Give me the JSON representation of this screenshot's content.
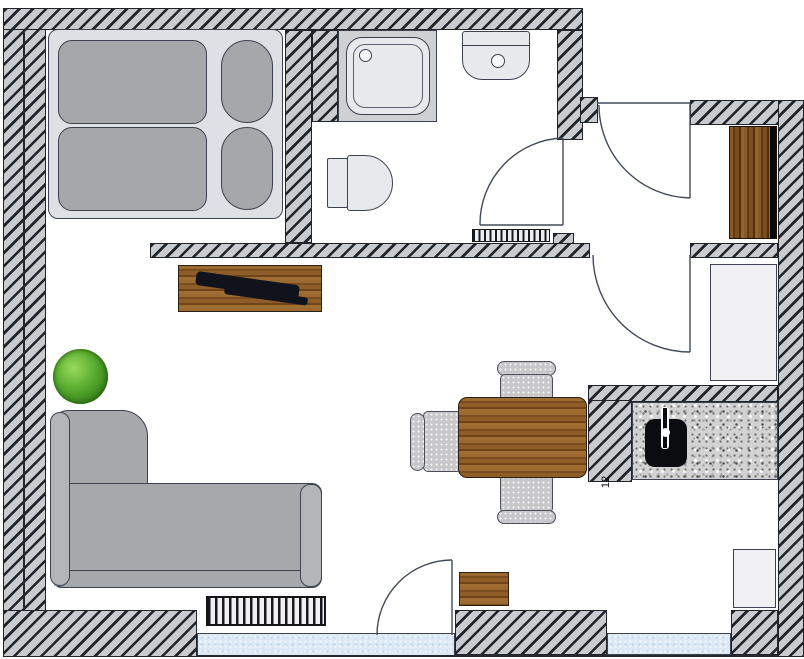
{
  "meta": {
    "type": "apartment-floor-plan",
    "width_px": 804,
    "height_px": 659
  },
  "labels": {
    "counter_number": "12"
  },
  "palette": {
    "wall_fill": "#c9cbcf",
    "wall_stripe": "#20242b",
    "line": "#3c4250",
    "wood_light": "#9c6a30",
    "wood_dark": "#5f3a14",
    "granite": "#d2d2d2",
    "window_glass": "#dce8f5",
    "sofa_gray": "#a6a8ab",
    "mattress_gray": "#a6a7aa",
    "bed_frame_gray": "#dde0e4",
    "plant_green": "#4f9d2d",
    "fixture_fill": "#e8e9ec",
    "appliance_fill": "#f1f1f3",
    "kitchen_sink_black": "#0b0c10"
  },
  "legend": {
    "furniture": [
      "double-bed",
      "mattress",
      "pillow",
      "shower",
      "washbasin",
      "toilet",
      "wardrobe",
      "refrigerator",
      "kitchen-counter",
      "kitchen-sink",
      "faucet",
      "sideboard",
      "tv",
      "plant",
      "corner-sofa",
      "radiator",
      "dining-table",
      "dining-chair",
      "stool",
      "appliance",
      "window",
      "door-swing",
      "ventilation-grille"
    ]
  }
}
